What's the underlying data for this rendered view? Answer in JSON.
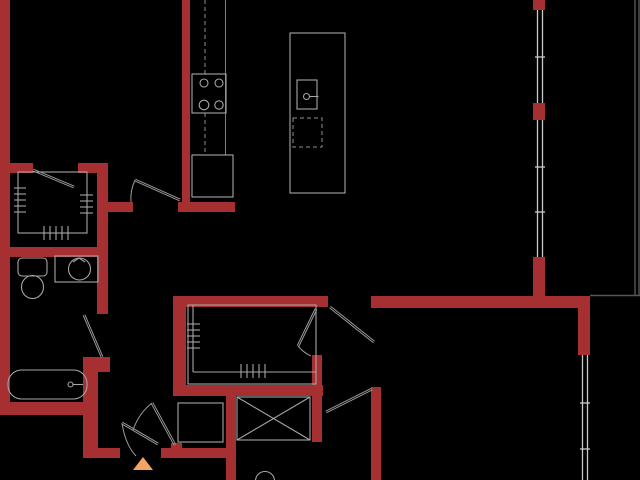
{
  "canvas": {
    "width": 640,
    "height": 480,
    "background": "#000000"
  },
  "styles": {
    "wall": {
      "f": "#a52f31"
    },
    "fix": {
      "s": "#a6a6a6",
      "w": 1.1
    },
    "fixdim": {
      "s": "#7d7d7d",
      "w": 1
    },
    "dash": {
      "s": "#8f8f8f",
      "w": 1,
      "d": "4 3"
    },
    "win": {
      "s": "#c9c9c9",
      "w": 1.3
    },
    "door": {
      "s": "#9a9a9a",
      "w": 1
    },
    "bal": {
      "s": "#575757",
      "w": 1.4
    },
    "mark": {
      "f": "#f0a564"
    }
  },
  "shapes": [
    {
      "n": "wall-left",
      "t": "rect",
      "s": "wall",
      "x": 0,
      "y": 0,
      "w": 10,
      "h": 415
    },
    {
      "n": "wall-closet1-top-left",
      "t": "rect",
      "s": "wall",
      "x": 0,
      "y": 163,
      "w": 33,
      "h": 10
    },
    {
      "n": "wall-closet1-top-right",
      "t": "rect",
      "s": "wall",
      "x": 78,
      "y": 163,
      "w": 30,
      "h": 10
    },
    {
      "n": "wall-closet1-right",
      "t": "rect",
      "s": "wall",
      "x": 97,
      "y": 163,
      "w": 11,
      "h": 94
    },
    {
      "n": "wall-bed1-door-jamb",
      "t": "rect",
      "s": "wall",
      "x": 107,
      "y": 202,
      "w": 26,
      "h": 10
    },
    {
      "n": "wall-bath1-top",
      "t": "rect",
      "s": "wall",
      "x": 0,
      "y": 247,
      "w": 108,
      "h": 10
    },
    {
      "n": "wall-bath1-right-upper",
      "t": "rect",
      "s": "wall",
      "x": 97,
      "y": 257,
      "w": 11,
      "h": 57
    },
    {
      "n": "wall-bath1-corner",
      "t": "rect",
      "s": "wall",
      "x": 83,
      "y": 357,
      "w": 27,
      "h": 15
    },
    {
      "n": "wall-bath1-right-lower",
      "t": "rect",
      "s": "wall",
      "x": 83,
      "y": 372,
      "w": 15,
      "h": 86
    },
    {
      "n": "wall-bath1-bottom",
      "t": "rect",
      "s": "wall",
      "x": 0,
      "y": 402,
      "w": 87,
      "h": 13
    },
    {
      "n": "wall-entry-left",
      "t": "rect",
      "s": "wall",
      "x": 90,
      "y": 448,
      "w": 30,
      "h": 10
    },
    {
      "n": "wall-entry-right",
      "t": "rect",
      "s": "wall",
      "x": 161,
      "y": 448,
      "w": 72,
      "h": 10
    },
    {
      "n": "wall-laundry-jamb",
      "t": "rect",
      "s": "wall",
      "x": 171,
      "y": 443,
      "w": 11,
      "h": 6
    },
    {
      "n": "wall-kitchen",
      "t": "rect",
      "s": "wall",
      "x": 182,
      "y": 0,
      "w": 8,
      "h": 204
    },
    {
      "n": "wall-kitchen-foot",
      "t": "rect",
      "s": "wall",
      "x": 178,
      "y": 202,
      "w": 57,
      "h": 10
    },
    {
      "n": "wall-closet2-top",
      "t": "rect",
      "s": "wall",
      "x": 173,
      "y": 296,
      "w": 155,
      "h": 11
    },
    {
      "n": "wall-closet2-left",
      "t": "rect",
      "s": "wall",
      "x": 173,
      "y": 296,
      "w": 13,
      "h": 99
    },
    {
      "n": "wall-closet2-bottom",
      "t": "rect",
      "s": "wall",
      "x": 173,
      "y": 385,
      "w": 150,
      "h": 11
    },
    {
      "n": "wall-closet2-right",
      "t": "rect",
      "s": "wall",
      "x": 312,
      "y": 355,
      "w": 10,
      "h": 87
    },
    {
      "n": "wall-laundry-right",
      "t": "rect",
      "s": "wall",
      "x": 226,
      "y": 396,
      "w": 10,
      "h": 84
    },
    {
      "n": "wall-bed2-left",
      "t": "rect",
      "s": "wall",
      "x": 371,
      "y": 387,
      "w": 10,
      "h": 93
    },
    {
      "n": "wall-living-south",
      "t": "rect",
      "s": "wall",
      "x": 371,
      "y": 296,
      "w": 219,
      "h": 12
    },
    {
      "n": "wall-window-jamb-top",
      "t": "rect",
      "s": "wall",
      "x": 533,
      "y": 0,
      "w": 12,
      "h": 10
    },
    {
      "n": "wall-window-jamb-mid",
      "t": "rect",
      "s": "wall",
      "x": 533,
      "y": 103,
      "w": 12,
      "h": 17
    },
    {
      "n": "wall-right-upper",
      "t": "rect",
      "s": "wall",
      "x": 533,
      "y": 257,
      "w": 12,
      "h": 41
    },
    {
      "n": "wall-right-corner",
      "t": "rect",
      "s": "wall",
      "x": 578,
      "y": 296,
      "w": 12,
      "h": 59
    },
    {
      "n": "window-1-outer",
      "t": "line",
      "s": "win",
      "x1": 537.5,
      "y1": 10,
      "x2": 537.5,
      "y2": 103
    },
    {
      "n": "window-1-inner",
      "t": "line",
      "s": "win",
      "x1": 542.5,
      "y1": 10,
      "x2": 542.5,
      "y2": 103
    },
    {
      "n": "window-1-mullion",
      "t": "line",
      "s": "win",
      "x1": 535,
      "y1": 57,
      "x2": 545,
      "y2": 57
    },
    {
      "n": "window-2-outer",
      "t": "line",
      "s": "win",
      "x1": 537.5,
      "y1": 120,
      "x2": 537.5,
      "y2": 257
    },
    {
      "n": "window-2-inner",
      "t": "line",
      "s": "win",
      "x1": 542.5,
      "y1": 120,
      "x2": 542.5,
      "y2": 257
    },
    {
      "n": "window-2-mullion-a",
      "t": "line",
      "s": "win",
      "x1": 535,
      "y1": 167,
      "x2": 545,
      "y2": 167
    },
    {
      "n": "window-2-mullion-b",
      "t": "line",
      "s": "win",
      "x1": 535,
      "y1": 212,
      "x2": 545,
      "y2": 212
    },
    {
      "n": "window-3-outer",
      "t": "line",
      "s": "win",
      "x1": 582.5,
      "y1": 355,
      "x2": 582.5,
      "y2": 480
    },
    {
      "n": "window-3-inner",
      "t": "line",
      "s": "win",
      "x1": 587.5,
      "y1": 355,
      "x2": 587.5,
      "y2": 480
    },
    {
      "n": "window-3-mullion-a",
      "t": "line",
      "s": "win",
      "x1": 580,
      "y1": 403,
      "x2": 590,
      "y2": 403
    },
    {
      "n": "window-3-mullion-b",
      "t": "line",
      "s": "win",
      "x1": 580,
      "y1": 449,
      "x2": 590,
      "y2": 449
    },
    {
      "n": "balcony-edge-vertical",
      "t": "line",
      "s": "bal",
      "x1": 635,
      "y1": 0,
      "x2": 635,
      "y2": 296
    },
    {
      "n": "balcony-edge-vertical-outer",
      "t": "line",
      "s": "bal",
      "x1": 639,
      "y1": 0,
      "x2": 639,
      "y2": 296
    },
    {
      "n": "balcony-edge-horizontal",
      "t": "line",
      "s": "bal",
      "x1": 590,
      "y1": 295.5,
      "x2": 640,
      "y2": 295.5
    },
    {
      "n": "kitchen-counter-edge",
      "t": "line",
      "s": "fixdim",
      "x1": 225.5,
      "y1": 0,
      "x2": 225.5,
      "y2": 155
    },
    {
      "n": "kitchen-upper-cabinet-a",
      "t": "line",
      "s": "dash",
      "x1": 205,
      "y1": 0,
      "x2": 205,
      "y2": 74
    },
    {
      "n": "kitchen-upper-cabinet-b",
      "t": "line",
      "s": "dash",
      "x1": 205,
      "y1": 113,
      "x2": 205,
      "y2": 155
    },
    {
      "n": "stove",
      "t": "rect",
      "s": "fix",
      "x": 192,
      "y": 74,
      "w": 34,
      "h": 39
    },
    {
      "n": "stove-burner-1",
      "t": "circle",
      "s": "fix",
      "cx": 204,
      "cy": 83,
      "r": 4
    },
    {
      "n": "stove-burner-2",
      "t": "circle",
      "s": "fix",
      "cx": 219,
      "cy": 83,
      "r": 4
    },
    {
      "n": "stove-burner-3",
      "t": "circle",
      "s": "fix",
      "cx": 204,
      "cy": 105,
      "r": 4.8
    },
    {
      "n": "stove-burner-4",
      "t": "circle",
      "s": "fix",
      "cx": 219,
      "cy": 105,
      "r": 4.2
    },
    {
      "n": "refrigerator",
      "t": "rect",
      "s": "fix",
      "x": 192,
      "y": 155,
      "w": 41,
      "h": 42
    },
    {
      "n": "kitchen-island",
      "t": "rect",
      "s": "fix",
      "x": 290,
      "y": 33,
      "w": 55,
      "h": 160
    },
    {
      "n": "island-sink",
      "t": "rect",
      "s": "fix",
      "x": 297,
      "y": 80,
      "w": 20,
      "h": 29
    },
    {
      "n": "island-faucet",
      "t": "circle",
      "s": "fix",
      "cx": 306.5,
      "cy": 96.5,
      "r": 3
    },
    {
      "n": "island-faucet-handle",
      "t": "line",
      "s": "fix",
      "x1": 309.5,
      "y1": 96.5,
      "x2": 318.5,
      "y2": 96.5
    },
    {
      "n": "dishwasher",
      "t": "rect",
      "s": "dash",
      "x": 293,
      "y": 118,
      "w": 29,
      "h": 29
    },
    {
      "n": "closet1-interior",
      "t": "rect",
      "s": "fix",
      "x": 18,
      "y": 172,
      "w": 69,
      "h": 61
    },
    {
      "n": "closet1-rod-ticks-left",
      "t": "ticks",
      "s": "fix",
      "o": "h",
      "x1": 14,
      "x2": 26,
      "y": 188,
      "step": 6,
      "num": 5
    },
    {
      "n": "closet1-rod-ticks-right",
      "t": "ticks",
      "s": "fix",
      "o": "h",
      "x1": 80,
      "x2": 93,
      "y": 195,
      "step": 6,
      "num": 4
    },
    {
      "n": "closet1-rod-ticks-bottom",
      "t": "ticks",
      "s": "fix",
      "o": "v",
      "y1": 226,
      "y2": 240,
      "x": 44,
      "step": 6,
      "num": 5
    },
    {
      "n": "closet2-interior",
      "t": "rect",
      "s": "fix",
      "x": 188,
      "y": 305,
      "w": 128,
      "h": 79
    },
    {
      "n": "closet2-rod-left",
      "t": "line",
      "s": "fix",
      "x1": 193,
      "y1": 305,
      "x2": 193,
      "y2": 372
    },
    {
      "n": "closet2-rod-bottom",
      "t": "line",
      "s": "fix",
      "x1": 193,
      "y1": 372,
      "x2": 316,
      "y2": 372
    },
    {
      "n": "closet2-rod-ticks-left",
      "t": "ticks",
      "s": "fix",
      "o": "h",
      "x1": 187,
      "x2": 200,
      "y": 324,
      "step": 6,
      "num": 5
    },
    {
      "n": "closet2-rod-ticks-bottom",
      "t": "ticks",
      "s": "fix",
      "o": "v",
      "y1": 364,
      "y2": 378,
      "x": 241,
      "step": 6,
      "num": 5
    },
    {
      "n": "closet1-door",
      "t": "dline",
      "s": "door",
      "x1": 33,
      "y1": 170,
      "x2": 74,
      "y2": 187
    },
    {
      "n": "bedroom1-door",
      "t": "dline",
      "s": "door",
      "x1": 180,
      "y1": 200,
      "x2": 135,
      "y2": 180
    },
    {
      "n": "bedroom1-door-arc",
      "t": "path",
      "s": "door",
      "d": "M135,180 Q130,191 131,202"
    },
    {
      "n": "bathroom1-door",
      "t": "dline",
      "s": "door",
      "x1": 102,
      "y1": 357,
      "x2": 84,
      "y2": 315
    },
    {
      "n": "bedroom2-door",
      "t": "dline",
      "s": "door",
      "x1": 330,
      "y1": 307,
      "x2": 374,
      "y2": 342
    },
    {
      "n": "closet2-door",
      "t": "dline",
      "s": "door",
      "x1": 316,
      "y1": 309,
      "x2": 298,
      "y2": 346
    },
    {
      "n": "closet2-door-arc",
      "t": "path",
      "s": "door",
      "d": "M298,346 Q304,353 311,356"
    },
    {
      "n": "bathroom2-door",
      "t": "dline",
      "s": "door",
      "x1": 372,
      "y1": 389,
      "x2": 326,
      "y2": 412
    },
    {
      "n": "laundry-door",
      "t": "dline",
      "s": "door",
      "x1": 152,
      "y1": 403,
      "x2": 175,
      "y2": 445
    },
    {
      "n": "laundry-door-arc",
      "t": "path",
      "s": "door",
      "d": "M152,403 Q139,413 133,430"
    },
    {
      "n": "entry-door",
      "t": "dline",
      "s": "door",
      "x1": 158,
      "y1": 444,
      "x2": 122,
      "y2": 423
    },
    {
      "n": "entry-door-arc",
      "t": "path",
      "s": "door",
      "d": "M122,423 Q125,444 136,456"
    },
    {
      "n": "toilet-tank",
      "t": "rrect",
      "s": "fix",
      "x": 18,
      "y": 258,
      "w": 29,
      "h": 18,
      "rx": 4
    },
    {
      "n": "toilet-bowl",
      "t": "ellipse",
      "s": "fix",
      "cx": 32.5,
      "cy": 287,
      "rx": 11,
      "ry": 11.5
    },
    {
      "n": "vanity",
      "t": "rect",
      "s": "fix",
      "x": 55,
      "y": 256,
      "w": 43,
      "h": 26
    },
    {
      "n": "vanity-sink",
      "t": "circle",
      "s": "fix",
      "cx": 79.5,
      "cy": 269,
      "r": 11
    },
    {
      "n": "vanity-faucet",
      "t": "path",
      "s": "fix",
      "d": "M73,262 L79,258 L85,262"
    },
    {
      "n": "bathtub",
      "t": "rrect",
      "s": "fix",
      "x": 8,
      "y": 370,
      "w": 79,
      "h": 29,
      "rx": 13.5
    },
    {
      "n": "tub-faucet-knob",
      "t": "circle",
      "s": "fix",
      "cx": 70.5,
      "cy": 384.5,
      "r": 2.5
    },
    {
      "n": "tub-faucet-spout",
      "t": "line",
      "s": "fix",
      "x1": 73,
      "y1": 384.5,
      "x2": 83,
      "y2": 384.5
    },
    {
      "n": "washer-dryer",
      "t": "rect",
      "s": "fix",
      "x": 178,
      "y": 403,
      "w": 45,
      "h": 39
    },
    {
      "n": "shower",
      "t": "rect",
      "s": "fix",
      "x": 237,
      "y": 397,
      "w": 73,
      "h": 43
    },
    {
      "n": "shower-diagonal-1",
      "t": "line",
      "s": "fix",
      "x1": 237,
      "y1": 397,
      "x2": 310,
      "y2": 440
    },
    {
      "n": "shower-diagonal-2",
      "t": "line",
      "s": "fix",
      "x1": 310,
      "y1": 397,
      "x2": 237,
      "y2": 440
    },
    {
      "n": "toilet2-bowl",
      "t": "circle",
      "s": "fix",
      "cx": 265,
      "cy": 481,
      "r": 9.5
    },
    {
      "n": "entry-marker-icon",
      "t": "poly",
      "s": "mark",
      "pts": "133,470 153,470 143,457"
    }
  ]
}
